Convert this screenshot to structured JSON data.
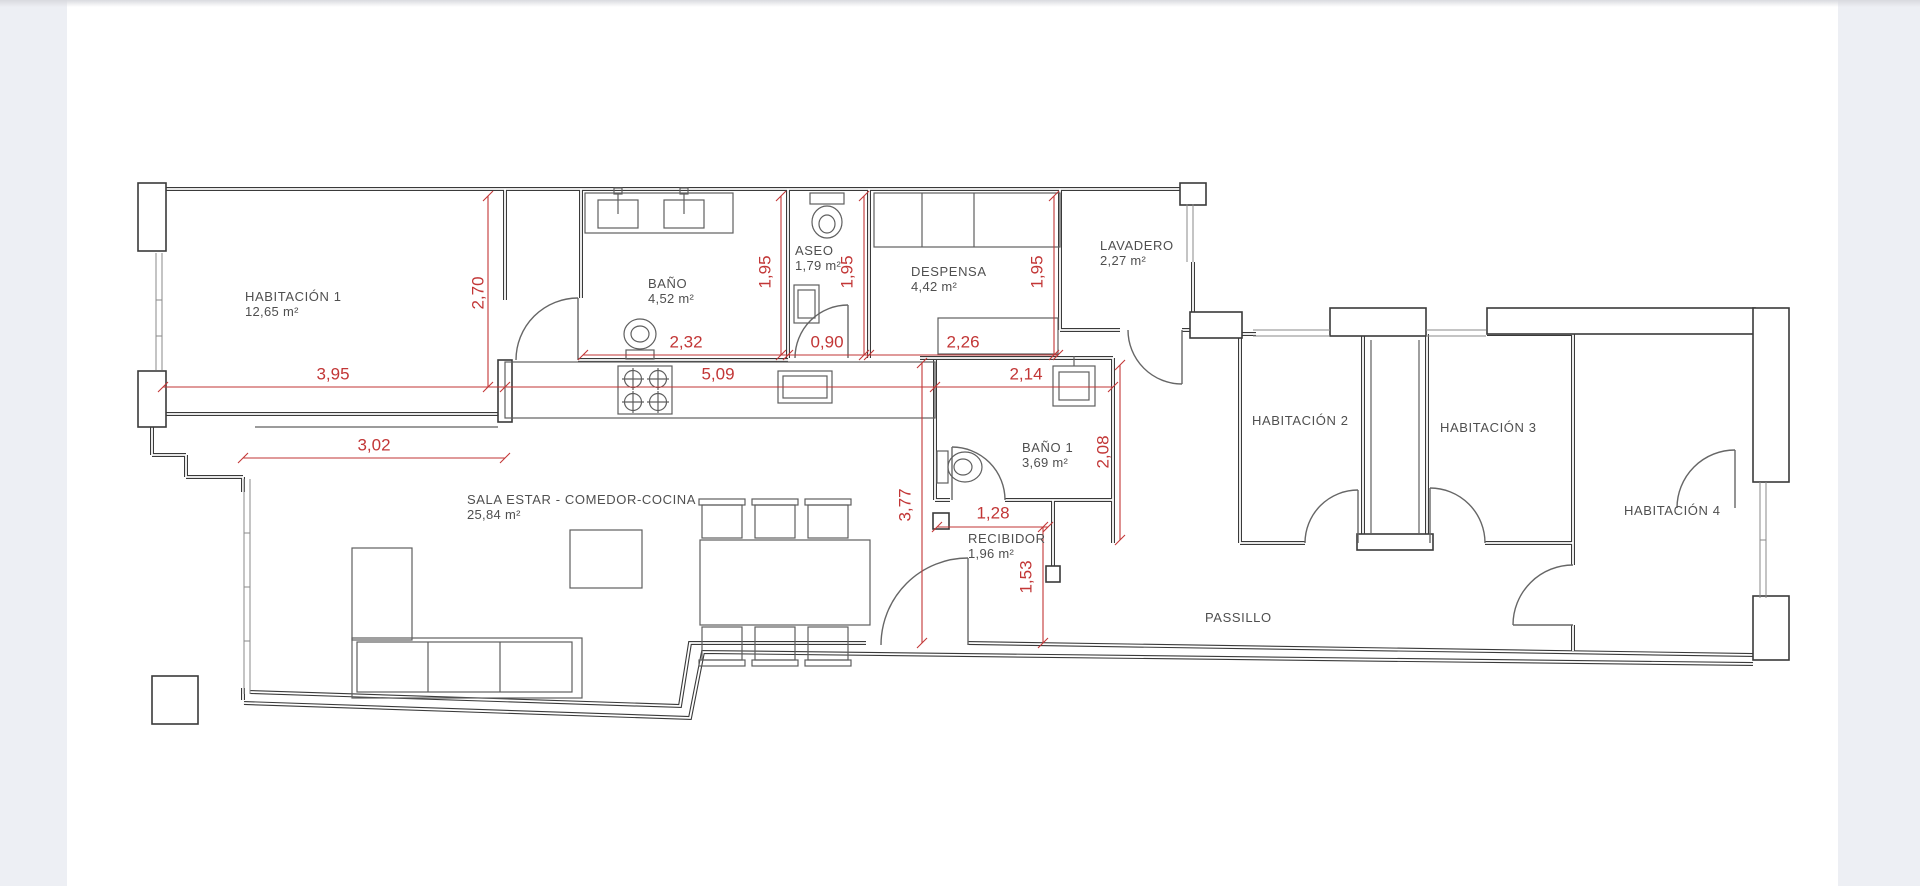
{
  "plan": {
    "rooms": [
      {
        "name": "HABITACIÓN 1",
        "area": "12,65 m²"
      },
      {
        "name": "BAÑO",
        "area": "4,52 m²"
      },
      {
        "name": "ASEO",
        "area": "1,79 m²"
      },
      {
        "name": "DESPENSA",
        "area": "4,42 m²"
      },
      {
        "name": "LAVADERO",
        "area": "2,27 m²"
      },
      {
        "name": "HABITACIÓN 2",
        "area": ""
      },
      {
        "name": "HABITACIÓN 3",
        "area": ""
      },
      {
        "name": "HABITACIÓN 4",
        "area": ""
      },
      {
        "name": "BAÑO 1",
        "area": "3,69 m²"
      },
      {
        "name": "SALA ESTAR - COMEDOR-COCINA",
        "area": "25,84 m²"
      },
      {
        "name": "RECIBIDOR",
        "area": "1,96 m²"
      },
      {
        "name": "PASSILLO",
        "area": ""
      }
    ],
    "dimensions": [
      {
        "value": "2,70",
        "orientation": "vertical"
      },
      {
        "value": "3,95",
        "orientation": "horizontal"
      },
      {
        "value": "5,09",
        "orientation": "horizontal"
      },
      {
        "value": "2,14",
        "orientation": "horizontal"
      },
      {
        "value": "3,02",
        "orientation": "horizontal"
      },
      {
        "value": "2,32",
        "orientation": "horizontal"
      },
      {
        "value": "0,90",
        "orientation": "horizontal"
      },
      {
        "value": "2,26",
        "orientation": "horizontal"
      },
      {
        "value": "1,95",
        "orientation": "vertical"
      },
      {
        "value": "1,95",
        "orientation": "vertical"
      },
      {
        "value": "1,95",
        "orientation": "vertical"
      },
      {
        "value": "2,08",
        "orientation": "vertical"
      },
      {
        "value": "3,77",
        "orientation": "vertical"
      },
      {
        "value": "1,53",
        "orientation": "vertical"
      },
      {
        "value": "1,28",
        "orientation": "horizontal"
      }
    ],
    "colors": {
      "dimension": "#c23636",
      "wall": "#3a3a3a",
      "paper": "#ffffff",
      "margin": "#edeff4"
    }
  }
}
